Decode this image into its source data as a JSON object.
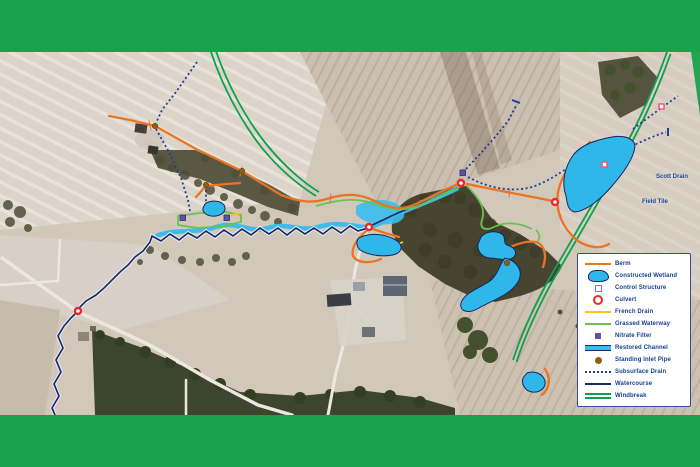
{
  "figure": {
    "type": "aerial-map-figure",
    "description": "Aerial farm drainage and wetland restoration map"
  },
  "map_labels": {
    "scott_drain": "Scott Drain",
    "field_tile": "Field Tile"
  },
  "legend": {
    "items": [
      {
        "id": "berm",
        "label": "Berm",
        "color": "#e87424"
      },
      {
        "id": "constructed-wetland",
        "label": "Constructed Wetland",
        "color": "#2fb7ea"
      },
      {
        "id": "control-structure",
        "label": "Control Structure",
        "color": "#ef4f7a"
      },
      {
        "id": "culvert",
        "label": "Culvert",
        "color": "#e62b2b"
      },
      {
        "id": "french-drain",
        "label": "French Drain",
        "color": "#f6c51f"
      },
      {
        "id": "grassed-waterway",
        "label": "Grassed Waterway",
        "color": "#6cc04f"
      },
      {
        "id": "nitrate-filter",
        "label": "Nitrate Filter",
        "color": "#5b55a4"
      },
      {
        "id": "restored-channel",
        "label": "Restored Channel",
        "color": "#3abced"
      },
      {
        "id": "standing-inlet-pipe",
        "label": "Standing Inlet Pipe",
        "color": "#8a6114"
      },
      {
        "id": "subsurface-drain",
        "label": "Subsurface Drain",
        "color": "#1d3e95"
      },
      {
        "id": "watercourse",
        "label": "Watercourse",
        "color": "#1b2a6b"
      },
      {
        "id": "windbreak",
        "label": "Windbreak",
        "color": "#0f9f4d"
      }
    ]
  },
  "colors": {
    "frame_green": "#17a24b",
    "field_base": "#d2c8ba",
    "woods_dark": "#43402c"
  }
}
